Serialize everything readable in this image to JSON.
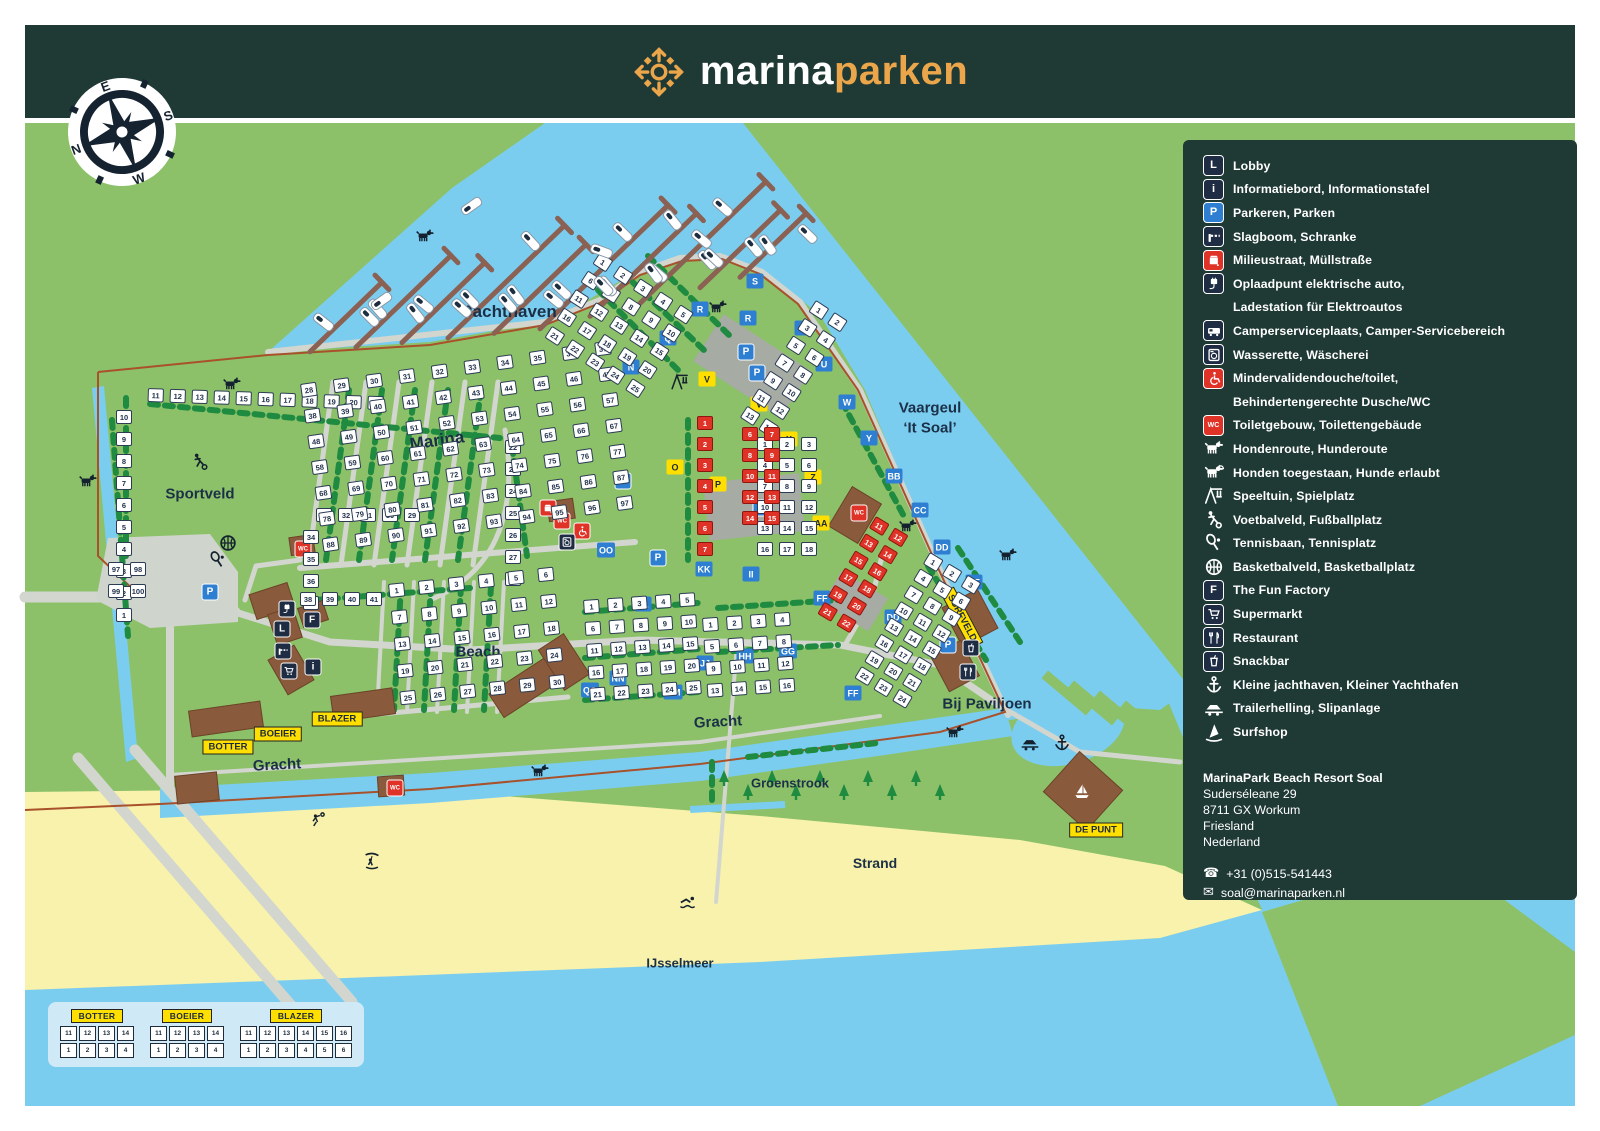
{
  "brand": {
    "primary": "marina",
    "secondary": "parken"
  },
  "compass": {
    "n": "N",
    "e": "E",
    "s": "S",
    "w": "W"
  },
  "colors": {
    "header_bg": "#1f3934",
    "land_green": "#8cc169",
    "water_blue": "#7bcdf0",
    "beach_sand": "#f8f2ac",
    "hedge_green": "#1f8b40",
    "building_brown": "#8a5a3c",
    "accent_orange": "#eba64b",
    "lot_red": "#e03328",
    "badge_blue": "#2e7fd2",
    "tag_yellow": "#ffdf00",
    "icon_navy": "#1f2d44"
  },
  "legend": {
    "items": [
      {
        "icon": "L",
        "style": "navy",
        "lines": [
          "Lobby"
        ]
      },
      {
        "icon": "i",
        "style": "navy",
        "lines": [
          "Informatiebord, Informationstafel"
        ]
      },
      {
        "icon": "P",
        "style": "blue",
        "lines": [
          "Parkeren, Parken"
        ]
      },
      {
        "icon": "barrier",
        "style": "navy",
        "lines": [
          "Slagboom, Schranke"
        ]
      },
      {
        "icon": "trash",
        "style": "red",
        "lines": [
          "Milieustraat, Müllstraße"
        ]
      },
      {
        "icon": "ev",
        "style": "navy",
        "lines": [
          "Oplaadpunt elektrische auto,",
          "Ladestation für Elektroautos"
        ]
      },
      {
        "icon": "camper",
        "style": "navy",
        "lines": [
          "Camperserviceplaats, Camper-Servicebereich"
        ]
      },
      {
        "icon": "washer",
        "style": "navy",
        "lines": [
          "Wasserette, Wäscherei"
        ]
      },
      {
        "icon": "wheelchair",
        "style": "red",
        "lines": [
          "Mindervalidendouche/toilet,",
          "Behindertengerechte Dusche/WC"
        ]
      },
      {
        "icon": "WC",
        "style": "red",
        "lines": [
          "Toiletgebouw, Toilettengebäude"
        ]
      },
      {
        "icon": "dog",
        "style": "plain",
        "lines": [
          "Hondenroute, Hunderoute"
        ]
      },
      {
        "icon": "dog-leash",
        "style": "plain",
        "lines": [
          "Honden toegestaan, Hunde erlaubt"
        ]
      },
      {
        "icon": "playground",
        "style": "plain",
        "lines": [
          "Speeltuin, Spielplatz"
        ]
      },
      {
        "icon": "footballer",
        "style": "plain",
        "lines": [
          "Voetbalveld, Fußballplatz"
        ]
      },
      {
        "icon": "tennis",
        "style": "plain",
        "lines": [
          "Tennisbaan, Tennisplatz"
        ]
      },
      {
        "icon": "basketball",
        "style": "plain",
        "lines": [
          "Basketbalveld, Basketballplatz"
        ]
      },
      {
        "icon": "F",
        "style": "navy",
        "lines": [
          "The Fun Factory"
        ]
      },
      {
        "icon": "cart",
        "style": "navy",
        "lines": [
          "Supermarkt"
        ]
      },
      {
        "icon": "restaurant",
        "style": "navy",
        "lines": [
          "Restaurant"
        ]
      },
      {
        "icon": "snackbar",
        "style": "navy",
        "lines": [
          "Snackbar"
        ]
      },
      {
        "icon": "anchor",
        "style": "plain",
        "lines": [
          "Kleine jachthaven, Kleiner Yachthafen"
        ]
      },
      {
        "icon": "trailer",
        "style": "plain",
        "lines": [
          "Trailerhelling, Slipanlage"
        ]
      },
      {
        "icon": "surfer",
        "style": "plain",
        "lines": [
          "Surfshop"
        ]
      }
    ],
    "resort": {
      "name": "MarinaPark Beach Resort Soal",
      "street": "Suderséleane 29",
      "postal": "8711 GX Workum",
      "region": "Friesland",
      "country": "Nederland",
      "phone": "+31 (0)515-541443",
      "email": "soal@marinaparken.nl"
    }
  },
  "map": {
    "labels": [
      {
        "t": "Jachthaven",
        "x": 510,
        "y": 312,
        "s": 17
      },
      {
        "t": "Marina",
        "x": 437,
        "y": 441,
        "s": 17,
        "rot": -8
      },
      {
        "t": "Sportveld",
        "x": 200,
        "y": 494,
        "s": 15
      },
      {
        "t": "Beach",
        "x": 478,
        "y": 652,
        "s": 15
      },
      {
        "t": "Gracht",
        "x": 718,
        "y": 722,
        "s": 15,
        "rot": -3
      },
      {
        "t": "Gracht",
        "x": 277,
        "y": 765,
        "s": 15,
        "rot": -3
      },
      {
        "t": "Groenstrook",
        "x": 790,
        "y": 783,
        "s": 13
      },
      {
        "t": "Strand",
        "x": 875,
        "y": 863,
        "s": 14
      },
      {
        "t": "IJsselmeer",
        "x": 680,
        "y": 963,
        "s": 13
      },
      {
        "t": "Vaargeul",
        "x": 930,
        "y": 408,
        "s": 15
      },
      {
        "t": "‘It Soal’",
        "x": 930,
        "y": 428,
        "s": 15
      },
      {
        "t": "Bij Paviljoen",
        "x": 987,
        "y": 704,
        "s": 15
      }
    ],
    "yellow_tags": [
      {
        "t": "BOTTER",
        "x": 228,
        "y": 747
      },
      {
        "t": "BOEIER",
        "x": 278,
        "y": 734
      },
      {
        "t": "BLAZER",
        "x": 337,
        "y": 719
      },
      {
        "t": "DE PUNT",
        "x": 1096,
        "y": 830
      },
      {
        "t": "SURFVELD",
        "x": 962,
        "y": 618,
        "rot": 62
      }
    ],
    "blue_badges": [
      {
        "t": "N",
        "x": 631,
        "y": 367
      },
      {
        "t": "Q",
        "x": 668,
        "y": 338
      },
      {
        "t": "R",
        "x": 700,
        "y": 309
      },
      {
        "t": "S",
        "x": 755,
        "y": 281
      },
      {
        "t": "R",
        "x": 748,
        "y": 318
      },
      {
        "t": "T",
        "x": 803,
        "y": 328
      },
      {
        "t": "U",
        "x": 824,
        "y": 364
      },
      {
        "t": "W",
        "x": 847,
        "y": 402
      },
      {
        "t": "Y",
        "x": 869,
        "y": 438
      },
      {
        "t": "BB",
        "x": 894,
        "y": 476
      },
      {
        "t": "CC",
        "x": 920,
        "y": 510
      },
      {
        "t": "DD",
        "x": 942,
        "y": 547
      },
      {
        "t": "DD",
        "x": 893,
        "y": 617
      },
      {
        "t": "EE",
        "x": 974,
        "y": 582
      },
      {
        "t": "FF",
        "x": 822,
        "y": 598
      },
      {
        "t": "FF",
        "x": 853,
        "y": 693
      },
      {
        "t": "GG",
        "x": 788,
        "y": 651
      },
      {
        "t": "HH",
        "x": 745,
        "y": 656
      },
      {
        "t": "II",
        "x": 751,
        "y": 574
      },
      {
        "t": "JJ",
        "x": 705,
        "y": 663
      },
      {
        "t": "KK",
        "x": 704,
        "y": 569
      },
      {
        "t": "LL",
        "x": 643,
        "y": 604
      },
      {
        "t": "MM",
        "x": 673,
        "y": 692
      },
      {
        "t": "NN",
        "x": 618,
        "y": 678
      },
      {
        "t": "OO",
        "x": 606,
        "y": 550
      },
      {
        "t": "QQ",
        "x": 590,
        "y": 690
      }
    ],
    "yellow_badges": [
      {
        "t": "V",
        "x": 707,
        "y": 379
      },
      {
        "t": "V",
        "x": 759,
        "y": 404
      },
      {
        "t": "X",
        "x": 789,
        "y": 439
      },
      {
        "t": "Z",
        "x": 813,
        "y": 477
      },
      {
        "t": "AA",
        "x": 821,
        "y": 523
      },
      {
        "t": "O",
        "x": 675,
        "y": 467
      },
      {
        "t": "P",
        "x": 718,
        "y": 484
      }
    ],
    "poi": [
      {
        "icon": "ev",
        "style": "navy",
        "x": 287,
        "y": 609
      },
      {
        "icon": "L",
        "style": "navy",
        "x": 282,
        "y": 629
      },
      {
        "icon": "F",
        "style": "navy",
        "x": 312,
        "y": 620
      },
      {
        "icon": "barrier",
        "style": "navy",
        "x": 283,
        "y": 651
      },
      {
        "icon": "cart",
        "style": "navy",
        "x": 289,
        "y": 671
      },
      {
        "icon": "i",
        "style": "navy",
        "x": 313,
        "y": 667
      },
      {
        "icon": "WC",
        "style": "red",
        "x": 303,
        "y": 549
      },
      {
        "icon": "WC",
        "style": "red",
        "x": 562,
        "y": 521
      },
      {
        "icon": "WC",
        "style": "red",
        "x": 859,
        "y": 513
      },
      {
        "icon": "WC",
        "style": "red",
        "x": 395,
        "y": 788
      },
      {
        "icon": "wheelchair",
        "style": "red",
        "x": 582,
        "y": 531
      },
      {
        "icon": "washer",
        "style": "navy",
        "x": 567,
        "y": 542
      },
      {
        "icon": "trash",
        "style": "red",
        "x": 548,
        "y": 508
      },
      {
        "icon": "P",
        "style": "blue",
        "x": 746,
        "y": 352
      },
      {
        "icon": "P",
        "style": "blue",
        "x": 757,
        "y": 373
      },
      {
        "icon": "P",
        "style": "blue",
        "x": 761,
        "y": 508
      },
      {
        "icon": "P",
        "style": "blue",
        "x": 658,
        "y": 558
      },
      {
        "icon": "P",
        "style": "blue",
        "x": 623,
        "y": 481
      },
      {
        "icon": "P",
        "style": "blue",
        "x": 948,
        "y": 645
      },
      {
        "icon": "P",
        "style": "blue",
        "x": 210,
        "y": 592
      },
      {
        "icon": "restaurant",
        "style": "navy",
        "x": 968,
        "y": 672
      },
      {
        "icon": "snackbar",
        "style": "navy",
        "x": 971,
        "y": 648
      }
    ],
    "glyphs": [
      {
        "icon": "dog",
        "x": 232,
        "y": 385
      },
      {
        "icon": "dog",
        "x": 425,
        "y": 237
      },
      {
        "icon": "dog",
        "x": 88,
        "y": 482
      },
      {
        "icon": "dog",
        "x": 540,
        "y": 772
      },
      {
        "icon": "dog",
        "x": 908,
        "y": 527
      },
      {
        "icon": "dog",
        "x": 955,
        "y": 733
      },
      {
        "icon": "dog",
        "x": 1008,
        "y": 556
      },
      {
        "icon": "dog",
        "x": 718,
        "y": 308
      },
      {
        "icon": "footballer",
        "x": 200,
        "y": 462
      },
      {
        "icon": "tennis",
        "x": 218,
        "y": 560
      },
      {
        "icon": "basketball",
        "x": 228,
        "y": 543
      },
      {
        "icon": "playground",
        "x": 680,
        "y": 382
      },
      {
        "icon": "anchor",
        "x": 1062,
        "y": 743
      },
      {
        "icon": "trailer",
        "x": 1030,
        "y": 743
      },
      {
        "icon": "swimmer",
        "x": 688,
        "y": 903
      },
      {
        "icon": "kitesurfer",
        "x": 372,
        "y": 862
      },
      {
        "icon": "volleyball",
        "x": 318,
        "y": 820
      },
      {
        "icon": "sailboat",
        "x": 1082,
        "y": 792,
        "light": true
      }
    ],
    "lot_clusters": [
      {
        "x": 148,
        "y": 388,
        "cols": 11,
        "rows": 1,
        "start": 11,
        "rot": 2
      },
      {
        "x": 116,
        "y": 410,
        "cols": 1,
        "rows": 10,
        "start": 10,
        "desc": true
      },
      {
        "x": 505,
        "y": 440,
        "cols": 1,
        "rows": 7,
        "start": 22
      },
      {
        "x": 316,
        "y": 508,
        "cols": 5,
        "rows": 1,
        "start": 33,
        "desc": true
      },
      {
        "x": 303,
        "y": 530,
        "cols": 1,
        "rows": 4,
        "start": 34
      },
      {
        "x": 300,
        "y": 592,
        "cols": 4,
        "rows": 1,
        "start": 38
      },
      {
        "x": 108,
        "y": 562,
        "cols": 2,
        "rows": 2,
        "start": 97
      },
      {
        "x": 300,
        "y": 384,
        "cols": 10,
        "rows": 7,
        "start": 28,
        "rot": -8,
        "gx": 33,
        "gy": 26
      },
      {
        "x": 388,
        "y": 584,
        "cols": 6,
        "rows": 5,
        "start": 1,
        "rot": -6,
        "gx": 30,
        "gy": 27
      },
      {
        "x": 600,
        "y": 252,
        "cols": 5,
        "rows": 5,
        "start": 1,
        "rot": 33,
        "gx": 24,
        "gy": 22
      },
      {
        "x": 816,
        "y": 300,
        "cols": 2,
        "rows": 7,
        "start": 1,
        "rot": 33,
        "gx": 22,
        "gy": 21
      },
      {
        "x": 757,
        "y": 437,
        "cols": 3,
        "rows": 6,
        "start": 1,
        "gx": 22,
        "gy": 21
      },
      {
        "x": 583,
        "y": 600,
        "cols": 5,
        "rows": 5,
        "start": 1,
        "rot": -4,
        "gx": 24,
        "gy": 22
      },
      {
        "x": 702,
        "y": 618,
        "cols": 4,
        "rows": 4,
        "start": 1,
        "rot": -4,
        "gx": 24,
        "gy": 22
      },
      {
        "x": 930,
        "y": 552,
        "cols": 3,
        "rows": 8,
        "start": 1,
        "rot": 31,
        "gx": 22,
        "gy": 19
      },
      {
        "x": 697,
        "y": 416,
        "cols": 1,
        "rows": 7,
        "start": 1,
        "color": "red",
        "gy": 21
      },
      {
        "x": 742,
        "y": 427,
        "cols": 2,
        "rows": 5,
        "start": 6,
        "color": "red",
        "gx": 22,
        "gy": 21
      },
      {
        "x": 876,
        "y": 516,
        "cols": 2,
        "rows": 6,
        "start": 11,
        "color": "red",
        "rot": 31,
        "gx": 22,
        "gy": 20
      }
    ]
  },
  "key_panel": {
    "groups": [
      {
        "name": "BOTTER",
        "rows": [
          [
            11,
            12,
            13,
            14
          ],
          [
            1,
            2,
            3,
            4
          ]
        ]
      },
      {
        "name": "BOEIER",
        "rows": [
          [
            11,
            12,
            13,
            14
          ],
          [
            1,
            2,
            3,
            4
          ]
        ]
      },
      {
        "name": "BLAZER",
        "rows": [
          [
            11,
            12,
            13,
            14,
            15,
            16
          ],
          [
            1,
            2,
            3,
            4,
            5,
            6
          ]
        ]
      }
    ]
  }
}
